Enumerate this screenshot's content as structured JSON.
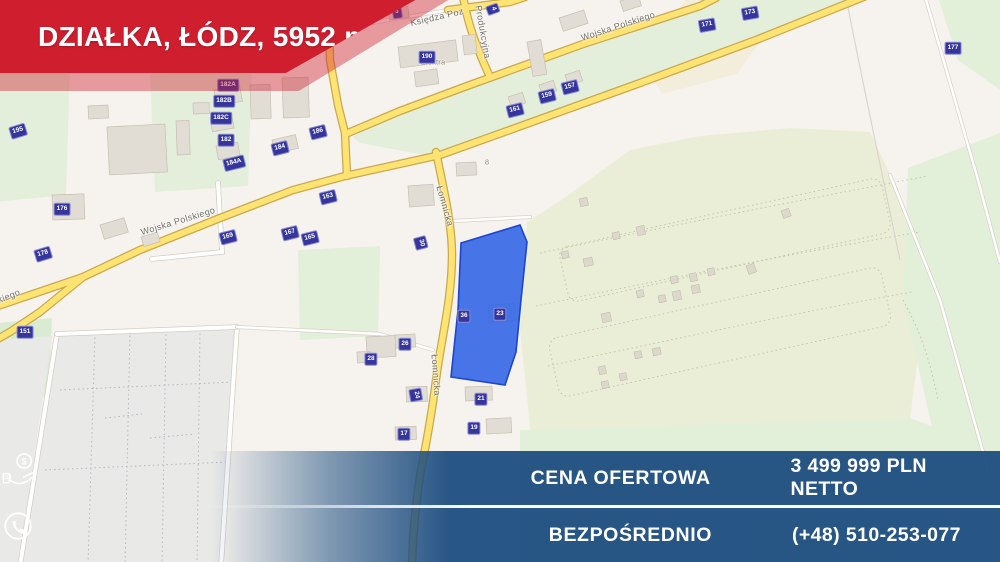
{
  "ribbon": {
    "title": "DZIAŁKA, ŁÓDZ, 5952 m",
    "title_sup": "2"
  },
  "offer": {
    "rows": [
      {
        "label": "CENA OFERTOWA",
        "icon": "money-hand-icon",
        "value": "3 499 999 PLN NETTO"
      },
      {
        "label": "BEZPOŚREDNIO",
        "icon": "phone-icon",
        "value": "(+48) 510-253-077"
      }
    ]
  },
  "colors": {
    "accent_red": "#cf1f2f",
    "banner_navy": "#1d4d80",
    "road_yellow": "#ffe373",
    "road_casing": "#c9a84c",
    "plot_blue": "#2f63e6",
    "plot_stroke": "#1c45d0",
    "badge_bg": "#35359b",
    "green_light": "#e3efdb",
    "green_allotment": "#ebeed7",
    "gray_area": "#e9e9e8",
    "land": "#f6f3ee"
  },
  "map": {
    "street_labels": [
      {
        "x": 618,
        "y": 26,
        "r": -18,
        "t": "Wojska Polskiego"
      },
      {
        "x": 178,
        "y": 221,
        "r": -17,
        "t": "Wojska Polskiego"
      },
      {
        "x": -16,
        "y": 306,
        "r": -22,
        "t": "Wojska Polskiego"
      },
      {
        "x": 437,
        "y": 17,
        "r": -13,
        "t": "Księdza Poz"
      },
      {
        "x": 483,
        "y": 32,
        "r": 80,
        "t": "Produkcyjna"
      },
      {
        "x": 445,
        "y": 206,
        "r": 74,
        "t": "Łomnicka"
      },
      {
        "x": 436,
        "y": 375,
        "r": 86,
        "t": "Łomnicka"
      }
    ],
    "poi_labels": [
      {
        "x": 433,
        "y": 62,
        "t": "Elektra"
      },
      {
        "x": 487,
        "y": 162,
        "t": "8"
      }
    ],
    "house_numbers": [
      {
        "x": 18,
        "y": 131,
        "n": "195",
        "r": -17
      },
      {
        "x": 62,
        "y": 209,
        "n": "176",
        "r": 0
      },
      {
        "x": 43,
        "y": 254,
        "n": "178",
        "r": -17
      },
      {
        "x": 25,
        "y": 332,
        "n": "151",
        "r": 0
      },
      {
        "x": 228,
        "y": 85,
        "n": "182A",
        "r": 0
      },
      {
        "x": 224,
        "y": 101,
        "n": "182B",
        "r": 0
      },
      {
        "x": 221,
        "y": 118,
        "n": "182C",
        "r": 0
      },
      {
        "x": 226,
        "y": 140,
        "n": "182",
        "r": 0
      },
      {
        "x": 234,
        "y": 163,
        "n": "184A",
        "r": -14
      },
      {
        "x": 280,
        "y": 148,
        "n": "184",
        "r": -14
      },
      {
        "x": 318,
        "y": 132,
        "n": "186",
        "r": -14
      },
      {
        "x": 328,
        "y": 197,
        "n": "163",
        "r": -14
      },
      {
        "x": 228,
        "y": 237,
        "n": "169",
        "r": -14
      },
      {
        "x": 290,
        "y": 233,
        "n": "167",
        "r": -14
      },
      {
        "x": 310,
        "y": 238,
        "n": "165",
        "r": -14
      },
      {
        "x": 427,
        "y": 57,
        "n": "190",
        "r": 0
      },
      {
        "x": 397,
        "y": 12,
        "n": "3",
        "r": -8
      },
      {
        "x": 493,
        "y": 9,
        "n": "4",
        "r": 70
      },
      {
        "x": 515,
        "y": 110,
        "n": "161",
        "r": -14
      },
      {
        "x": 547,
        "y": 96,
        "n": "159",
        "r": -14
      },
      {
        "x": 570,
        "y": 87,
        "n": "157",
        "r": -14
      },
      {
        "x": 707,
        "y": 25,
        "n": "171",
        "r": -10
      },
      {
        "x": 750,
        "y": 13,
        "n": "173",
        "r": -10
      },
      {
        "x": 953,
        "y": 48,
        "n": "177",
        "r": 0
      },
      {
        "x": 421,
        "y": 243,
        "n": "30",
        "r": 75
      },
      {
        "x": 371,
        "y": 359,
        "n": "28",
        "r": 0
      },
      {
        "x": 405,
        "y": 344,
        "n": "26",
        "r": 0
      },
      {
        "x": 416,
        "y": 395,
        "n": "24",
        "r": 80
      },
      {
        "x": 500,
        "y": 314,
        "n": "23",
        "r": 0
      },
      {
        "x": 481,
        "y": 399,
        "n": "21",
        "r": 0
      },
      {
        "x": 474,
        "y": 428,
        "n": "19",
        "r": 0
      },
      {
        "x": 404,
        "y": 434,
        "n": "17",
        "r": 0
      },
      {
        "x": 464,
        "y": 316,
        "n": "36",
        "r": 0
      }
    ]
  }
}
